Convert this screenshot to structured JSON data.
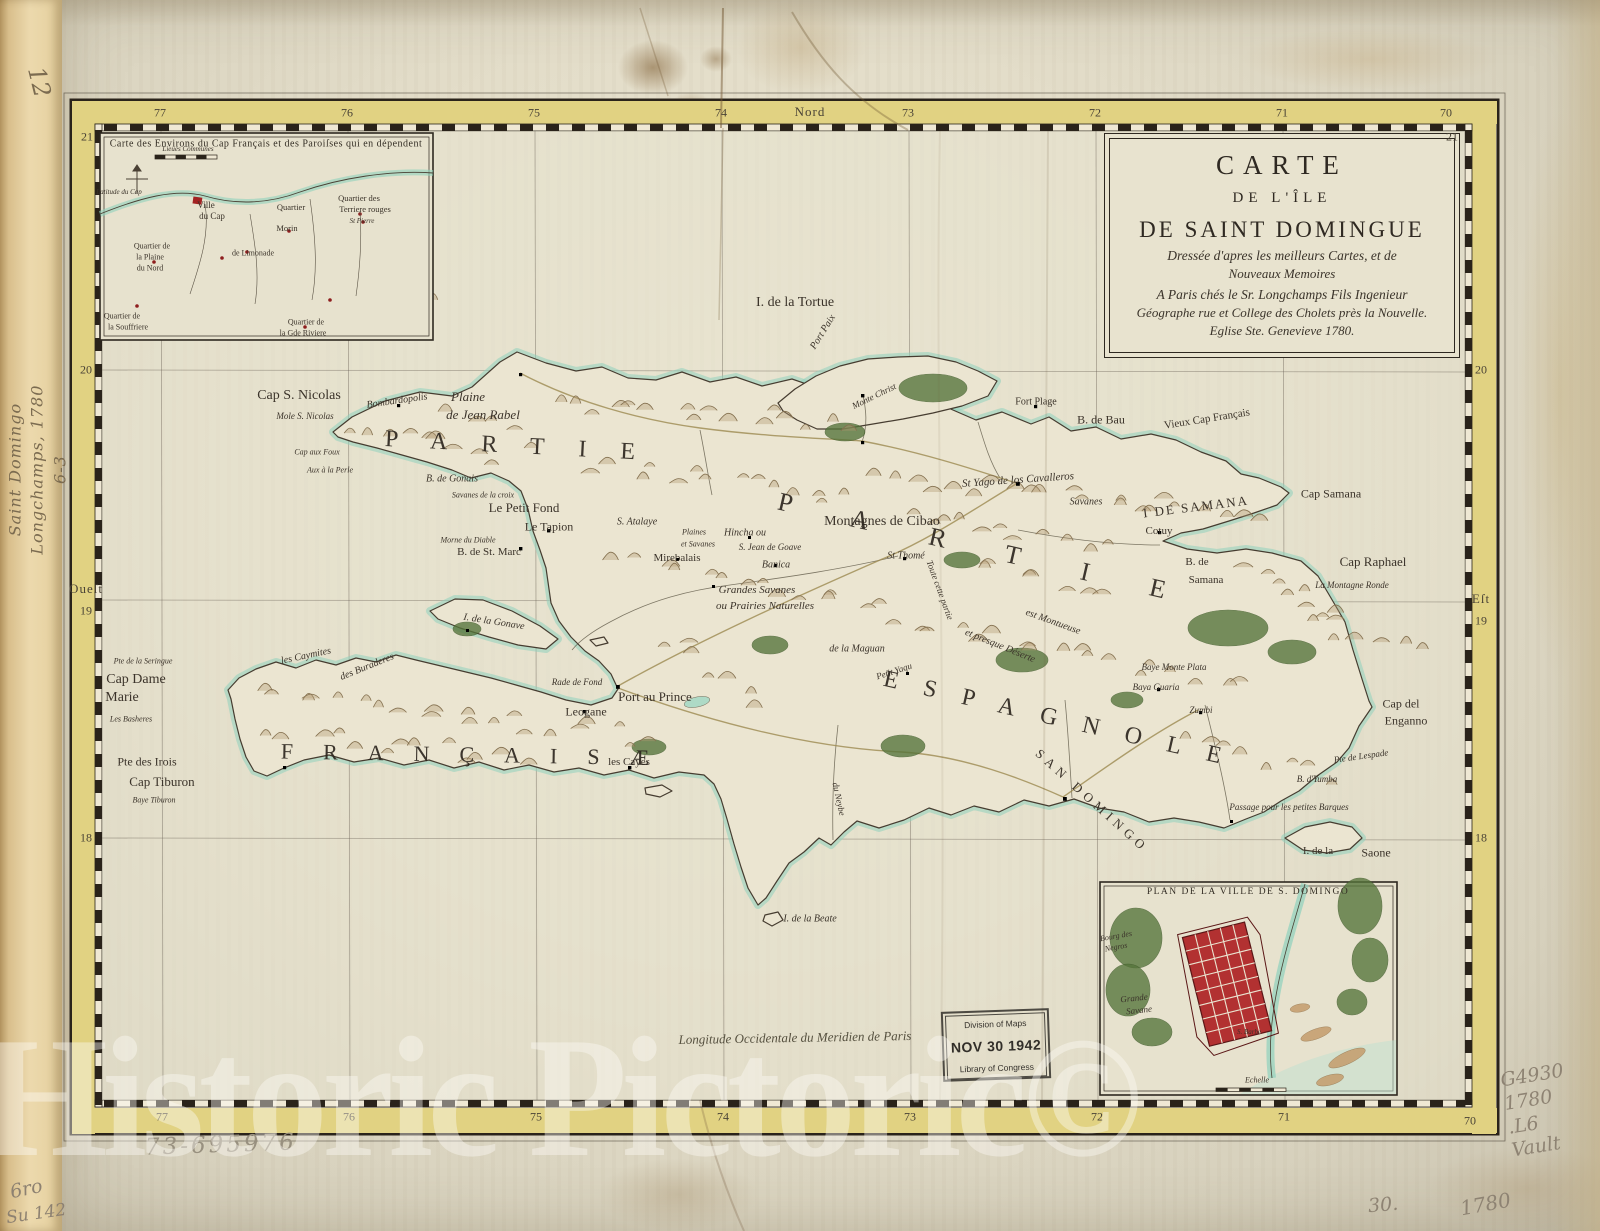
{
  "sheet": {
    "watermark": "Historic Pictoric©",
    "bottom_caption": "Longitude Occidentale du Meridien de Paris"
  },
  "annotations": {
    "spine_number": "12",
    "spine_note": [
      "Saint Domingo",
      "Longchamps, 1780",
      "6-3"
    ],
    "pencil_left": [
      "6ro",
      "Su 142"
    ],
    "catalog_number": "73-695976",
    "call_number": [
      "G4930",
      "1780",
      ".L6",
      "Vault"
    ],
    "plate_number": "30.",
    "year_note": "1780"
  },
  "stamp": {
    "line1": "Division of Maps",
    "line2": "NOV 30 1942",
    "line3": "Library of Congress"
  },
  "cartouche": {
    "t1": "CARTE",
    "t2": "DE L'ÎLE",
    "t3": "DE SAINT DOMINGUE",
    "s1": "Dressée d'apres les meilleurs Cartes, et de",
    "s2": "Nouveaux Memoires",
    "s3": "A Paris chés le Sr. Longchamps Fils Ingenieur",
    "s4": "Géographe rue et College des Cholets près la Nouvelle.",
    "s5": "Eglise Ste. Genevieve 1780."
  },
  "border": {
    "labels": [
      {
        "t": "Nord",
        "x": 810,
        "y": 112,
        "c": "dir"
      },
      {
        "t": "77",
        "x": 160,
        "y": 113,
        "c": "num"
      },
      {
        "t": "76",
        "x": 347,
        "y": 113,
        "c": "num"
      },
      {
        "t": "75",
        "x": 534,
        "y": 113,
        "c": "num"
      },
      {
        "t": "74",
        "x": 721,
        "y": 113,
        "c": "num"
      },
      {
        "t": "73",
        "x": 908,
        "y": 113,
        "c": "num"
      },
      {
        "t": "72",
        "x": 1095,
        "y": 113,
        "c": "num"
      },
      {
        "t": "71",
        "x": 1282,
        "y": 113,
        "c": "num"
      },
      {
        "t": "70",
        "x": 1446,
        "y": 113,
        "c": "num"
      },
      {
        "t": "21",
        "x": 87,
        "y": 137,
        "c": "num"
      },
      {
        "t": "21",
        "x": 1452,
        "y": 137,
        "c": "num"
      },
      {
        "t": "20",
        "x": 86,
        "y": 370,
        "c": "num"
      },
      {
        "t": "20",
        "x": 1481,
        "y": 370,
        "c": "num"
      },
      {
        "t": "Oueſt",
        "x": 86,
        "y": 589,
        "c": "dir"
      },
      {
        "t": "19",
        "x": 86,
        "y": 611,
        "c": "num"
      },
      {
        "t": "Eſt",
        "x": 1481,
        "y": 599,
        "c": "dir"
      },
      {
        "t": "19",
        "x": 1481,
        "y": 621,
        "c": "num"
      },
      {
        "t": "18",
        "x": 86,
        "y": 838,
        "c": "num"
      },
      {
        "t": "18",
        "x": 1481,
        "y": 838,
        "c": "num"
      },
      {
        "t": "77",
        "x": 162,
        "y": 1117,
        "c": "num"
      },
      {
        "t": "76",
        "x": 349,
        "y": 1117,
        "c": "num"
      },
      {
        "t": "75",
        "x": 536,
        "y": 1117,
        "c": "num"
      },
      {
        "t": "74",
        "x": 723,
        "y": 1117,
        "c": "num"
      },
      {
        "t": "73",
        "x": 910,
        "y": 1117,
        "c": "num"
      },
      {
        "t": "72",
        "x": 1097,
        "y": 1117,
        "c": "num"
      },
      {
        "t": "71",
        "x": 1284,
        "y": 1117,
        "c": "num"
      },
      {
        "t": "70",
        "x": 1470,
        "y": 1121,
        "c": "num"
      }
    ]
  },
  "map": {
    "labels": [
      {
        "t": "I. de la Tortue",
        "x": 795,
        "y": 303,
        "s": 14
      },
      {
        "t": "Port Paix",
        "x": 823,
        "y": 332,
        "s": 10,
        "r": -58,
        "c": "it"
      },
      {
        "t": "Cap S. Nicolas",
        "x": 299,
        "y": 396,
        "s": 14
      },
      {
        "t": "Mole S. Nicolas",
        "x": 305,
        "y": 416,
        "s": 9,
        "c": "it"
      },
      {
        "t": "Bombardopolis",
        "x": 397,
        "y": 401,
        "s": 10,
        "r": -8,
        "c": "it"
      },
      {
        "t": "Plaine",
        "x": 468,
        "y": 397,
        "s": 13,
        "c": "it"
      },
      {
        "t": "de Jean Rabel",
        "x": 483,
        "y": 415,
        "s": 13,
        "c": "it"
      },
      {
        "t": "Cap aux Foux",
        "x": 317,
        "y": 452,
        "s": 8,
        "c": "it"
      },
      {
        "t": "Aux à la Perle",
        "x": 330,
        "y": 470,
        "s": 8,
        "c": "it"
      },
      {
        "t": "B. de Gonais",
        "x": 452,
        "y": 479,
        "s": 10,
        "c": "it"
      },
      {
        "t": "Savanes de la croix",
        "x": 483,
        "y": 495,
        "s": 8,
        "c": "it"
      },
      {
        "t": "Le Petit Fond",
        "x": 524,
        "y": 508,
        "s": 13
      },
      {
        "t": "Le Tapion",
        "x": 549,
        "y": 527,
        "s": 12
      },
      {
        "t": "Morne du Diable",
        "x": 468,
        "y": 540,
        "s": 8,
        "c": "it"
      },
      {
        "t": "B. de St. Marc",
        "x": 489,
        "y": 552,
        "s": 11
      },
      {
        "t": "Mirebalais",
        "x": 677,
        "y": 558,
        "s": 11
      },
      {
        "t": "S. Atalaye",
        "x": 637,
        "y": 522,
        "s": 10,
        "c": "it"
      },
      {
        "t": "Plaines",
        "x": 694,
        "y": 532,
        "s": 8,
        "c": "it"
      },
      {
        "t": "et Savanes",
        "x": 698,
        "y": 544,
        "s": 8,
        "c": "it"
      },
      {
        "t": "Hincha ou",
        "x": 745,
        "y": 533,
        "s": 10,
        "c": "it"
      },
      {
        "t": "S. Jean de Goave",
        "x": 770,
        "y": 547,
        "s": 9,
        "c": "it"
      },
      {
        "t": "Montagnes de Cibao",
        "x": 882,
        "y": 522,
        "s": 14
      },
      {
        "t": "St Thomé",
        "x": 906,
        "y": 556,
        "s": 10,
        "c": "it"
      },
      {
        "t": "Banica",
        "x": 776,
        "y": 565,
        "s": 10,
        "c": "it"
      },
      {
        "t": "Grandes Savanes",
        "x": 757,
        "y": 590,
        "s": 11,
        "c": "it"
      },
      {
        "t": "ou Prairies Naturelles",
        "x": 765,
        "y": 606,
        "s": 11,
        "c": "it"
      },
      {
        "t": "Toute cette partie",
        "x": 940,
        "y": 590,
        "s": 9,
        "r": 70,
        "c": "it"
      },
      {
        "t": "est Montueuse",
        "x": 1053,
        "y": 622,
        "s": 10,
        "r": 20,
        "c": "it"
      },
      {
        "t": "et presque Déserte",
        "x": 1000,
        "y": 646,
        "s": 10,
        "r": 22,
        "c": "it"
      },
      {
        "t": "Port au Prince",
        "x": 655,
        "y": 697,
        "s": 13
      },
      {
        "t": "Leogane",
        "x": 586,
        "y": 712,
        "s": 12
      },
      {
        "t": "Rade de Fond",
        "x": 577,
        "y": 682,
        "s": 9,
        "c": "it"
      },
      {
        "t": "les Cayes",
        "x": 629,
        "y": 762,
        "s": 11
      },
      {
        "t": "Cap Dame",
        "x": 136,
        "y": 680,
        "s": 14
      },
      {
        "t": "Marie",
        "x": 122,
        "y": 698,
        "s": 14
      },
      {
        "t": "Les Basheres",
        "x": 131,
        "y": 719,
        "s": 8,
        "c": "it"
      },
      {
        "t": "Pte de la Seringue",
        "x": 143,
        "y": 661,
        "s": 8,
        "c": "it"
      },
      {
        "t": "Pte des Irois",
        "x": 147,
        "y": 762,
        "s": 12
      },
      {
        "t": "Cap Tiburon",
        "x": 162,
        "y": 782,
        "s": 13
      },
      {
        "t": "Baye Tiburon",
        "x": 154,
        "y": 800,
        "s": 8,
        "c": "it"
      },
      {
        "t": "les Caymites",
        "x": 306,
        "y": 656,
        "s": 10,
        "r": -12,
        "c": "it"
      },
      {
        "t": "des Buraderes",
        "x": 367,
        "y": 667,
        "s": 10,
        "r": -22,
        "c": "it"
      },
      {
        "t": "I. de la Gonave",
        "x": 494,
        "y": 622,
        "s": 10,
        "r": 9,
        "c": "it"
      },
      {
        "t": "I DE SAMANA",
        "x": 1196,
        "y": 507,
        "s": 13,
        "ls": 2,
        "r": -7
      },
      {
        "t": "Cap Samana",
        "x": 1331,
        "y": 494,
        "s": 12
      },
      {
        "t": "B. de",
        "x": 1197,
        "y": 562,
        "s": 11
      },
      {
        "t": "Samana",
        "x": 1206,
        "y": 580,
        "s": 11
      },
      {
        "t": "Cap Raphael",
        "x": 1373,
        "y": 562,
        "s": 13
      },
      {
        "t": "La Montagne Ronde",
        "x": 1352,
        "y": 585,
        "s": 9,
        "c": "it"
      },
      {
        "t": "Cap del",
        "x": 1401,
        "y": 704,
        "s": 12
      },
      {
        "t": "Enganno",
        "x": 1406,
        "y": 721,
        "s": 12
      },
      {
        "t": "Pte de Lespade",
        "x": 1361,
        "y": 756,
        "s": 9,
        "r": -8,
        "c": "it"
      },
      {
        "t": "B. d'Yumba",
        "x": 1317,
        "y": 779,
        "s": 9,
        "c": "it"
      },
      {
        "t": "Passage pour les petites Barques",
        "x": 1289,
        "y": 807,
        "s": 9,
        "c": "it"
      },
      {
        "t": "I. de la",
        "x": 1318,
        "y": 851,
        "s": 11
      },
      {
        "t": "Saone",
        "x": 1376,
        "y": 853,
        "s": 12
      },
      {
        "t": "St Yago de los Cavalleros",
        "x": 1018,
        "y": 480,
        "s": 11,
        "r": -4,
        "c": "it"
      },
      {
        "t": "Savanes",
        "x": 1086,
        "y": 502,
        "s": 10,
        "c": "it"
      },
      {
        "t": "Cotuy",
        "x": 1159,
        "y": 531,
        "s": 11
      },
      {
        "t": "Fort Plage",
        "x": 1036,
        "y": 402,
        "s": 10
      },
      {
        "t": "B. de Bau",
        "x": 1101,
        "y": 420,
        "s": 12
      },
      {
        "t": "Vieux Cap Français",
        "x": 1207,
        "y": 419,
        "s": 11,
        "r": -9
      },
      {
        "t": "Monte Christ",
        "x": 874,
        "y": 396,
        "s": 9,
        "r": -26,
        "c": "it"
      },
      {
        "t": "Baye Monte Plata",
        "x": 1174,
        "y": 667,
        "s": 9,
        "c": "it"
      },
      {
        "t": "Baya Guaria",
        "x": 1156,
        "y": 687,
        "s": 9,
        "c": "it"
      },
      {
        "t": "Zumbi",
        "x": 1201,
        "y": 710,
        "s": 9,
        "c": "it"
      },
      {
        "t": "de la Maguan",
        "x": 857,
        "y": 649,
        "s": 10,
        "c": "it"
      },
      {
        "t": "Petit Yaqu",
        "x": 894,
        "y": 671,
        "s": 9,
        "r": -18,
        "c": "it"
      },
      {
        "t": "du Neybe",
        "x": 839,
        "y": 799,
        "s": 9,
        "r": 78,
        "c": "it"
      },
      {
        "t": "I. de la Beate",
        "x": 810,
        "y": 919,
        "s": 10,
        "c": "it"
      },
      {
        "t": "PARTIE",
        "x": 527,
        "y": 447,
        "s": 24,
        "ls": 34,
        "r": 3,
        "c": "big"
      },
      {
        "t": "PARTIE",
        "x": 1002,
        "y": 553,
        "s": 26,
        "ls": 62,
        "r": 13,
        "c": "big"
      },
      {
        "t": "FRANÇAISÆ",
        "x": 480,
        "y": 755,
        "s": 22,
        "ls": 30,
        "r": 1,
        "c": "big"
      },
      {
        "t": "ESPAGNOLE",
        "x": 1065,
        "y": 721,
        "s": 24,
        "ls": 26,
        "r": 13,
        "c": "big"
      },
      {
        "t": "SAN DOMINGO",
        "x": 1092,
        "y": 801,
        "s": 13,
        "ls": 5,
        "r": 42
      }
    ]
  },
  "inset_cap": {
    "labels": [
      {
        "t": "Carte des Environs du Cap Français et des Paroiſses qui en dépendent",
        "x": 266,
        "y": 144,
        "s": 10,
        "c": "title"
      },
      {
        "t": "Lieues Communes",
        "x": 188,
        "y": 149,
        "s": 7,
        "c": "it"
      },
      {
        "t": "Latitude du Cap",
        "x": 119,
        "y": 192,
        "s": 7,
        "c": "it"
      },
      {
        "t": "Ville",
        "x": 206,
        "y": 205,
        "s": 9
      },
      {
        "t": "du Cap",
        "x": 212,
        "y": 216,
        "s": 9
      },
      {
        "t": "Quartier",
        "x": 291,
        "y": 207,
        "s": 8.5
      },
      {
        "t": "Morin",
        "x": 287,
        "y": 228,
        "s": 8.5
      },
      {
        "t": "Quartier des",
        "x": 359,
        "y": 198,
        "s": 8.5
      },
      {
        "t": "Terriere rouges",
        "x": 365,
        "y": 209,
        "s": 8.5
      },
      {
        "t": "St Pierre",
        "x": 362,
        "y": 221,
        "s": 7,
        "c": "it"
      },
      {
        "t": "Quartier de",
        "x": 152,
        "y": 246,
        "s": 8
      },
      {
        "t": "la Plaine",
        "x": 150,
        "y": 257,
        "s": 8
      },
      {
        "t": "du Nord",
        "x": 150,
        "y": 268,
        "s": 8
      },
      {
        "t": "de Limonade",
        "x": 253,
        "y": 253,
        "s": 8
      },
      {
        "t": "Quartier de",
        "x": 306,
        "y": 322,
        "s": 8
      },
      {
        "t": "la Gde Riviere",
        "x": 303,
        "y": 333,
        "s": 8
      },
      {
        "t": "Quartier de",
        "x": 122,
        "y": 316,
        "s": 8
      },
      {
        "t": "la Souffriere",
        "x": 128,
        "y": 327,
        "s": 8
      }
    ]
  },
  "inset_plan": {
    "labels": [
      {
        "t": "PLAN DE LA VILLE DE S. DOMINGO",
        "x": 1248,
        "y": 892,
        "s": 9.5,
        "ls": 1.5,
        "c": "title"
      },
      {
        "t": "Bourg des",
        "x": 1116,
        "y": 936,
        "s": 8,
        "r": -10,
        "c": "it"
      },
      {
        "t": "Negros",
        "x": 1116,
        "y": 947,
        "s": 8,
        "r": -10,
        "c": "it"
      },
      {
        "t": "Grande",
        "x": 1134,
        "y": 998,
        "s": 9,
        "r": -6,
        "c": "it"
      },
      {
        "t": "Savane",
        "x": 1139,
        "y": 1010,
        "s": 9,
        "r": -6,
        "c": "it"
      },
      {
        "t": "S. Barbe",
        "x": 1249,
        "y": 1032,
        "s": 7,
        "c": "it"
      },
      {
        "t": "Echelle",
        "x": 1257,
        "y": 1080,
        "s": 8,
        "c": "it"
      }
    ]
  }
}
